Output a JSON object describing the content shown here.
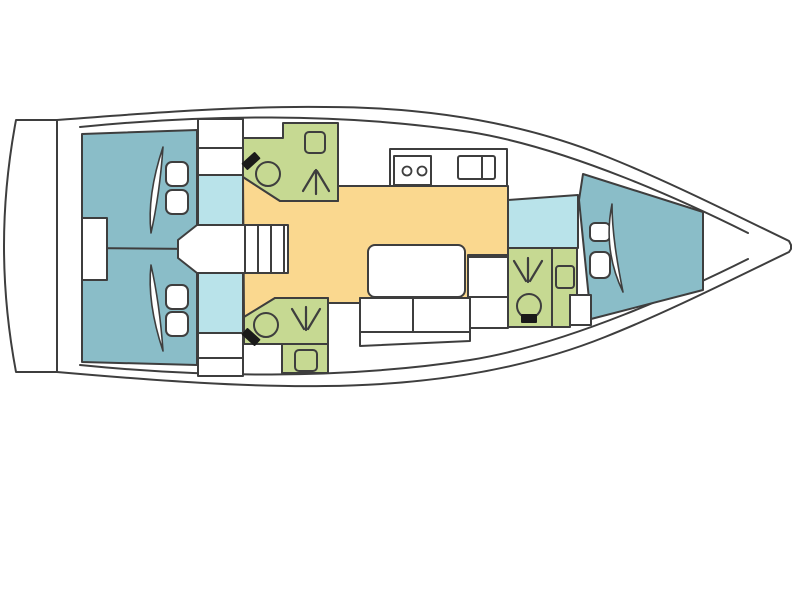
{
  "diagram": {
    "name": "sailing-yacht-interior-floor-plan",
    "view": "top-down deck plan",
    "bow_direction": "right",
    "stern_direction": "left"
  },
  "colors": {
    "outline": "#3e3e3e",
    "hull": "#ffffff",
    "cabin": "#8abdc8",
    "locker": "#b9e3ea",
    "head": "#c6d992",
    "salon": "#fad88f",
    "fixture": "#1a1a1a"
  },
  "areas": {
    "aft_port_cabin": "double berth with pillows",
    "aft_starboard_cabin": "double berth with pillows",
    "forward_cabin": "v-berth with pillows",
    "port_head": "toilet, shower, sink",
    "starboard_head": "toilet, shower, sink",
    "forward_head": "toilet, shower, sink",
    "salon": "table, settee, nav seats",
    "galley": "two-burner stove, double sink",
    "companionway": "entry steps",
    "stern_platform": "transom swim platform"
  },
  "icons": {
    "toilet": "circle bowl with black cistern",
    "shower": "three-line spray arrow",
    "sink": "rounded square basin",
    "stove": "rectangle with two burner circles",
    "galley_sink": "double basin rectangle",
    "berth": "mattress with blanket fold",
    "steps": "parallel ladder treads",
    "table": "rounded white rectangle"
  }
}
